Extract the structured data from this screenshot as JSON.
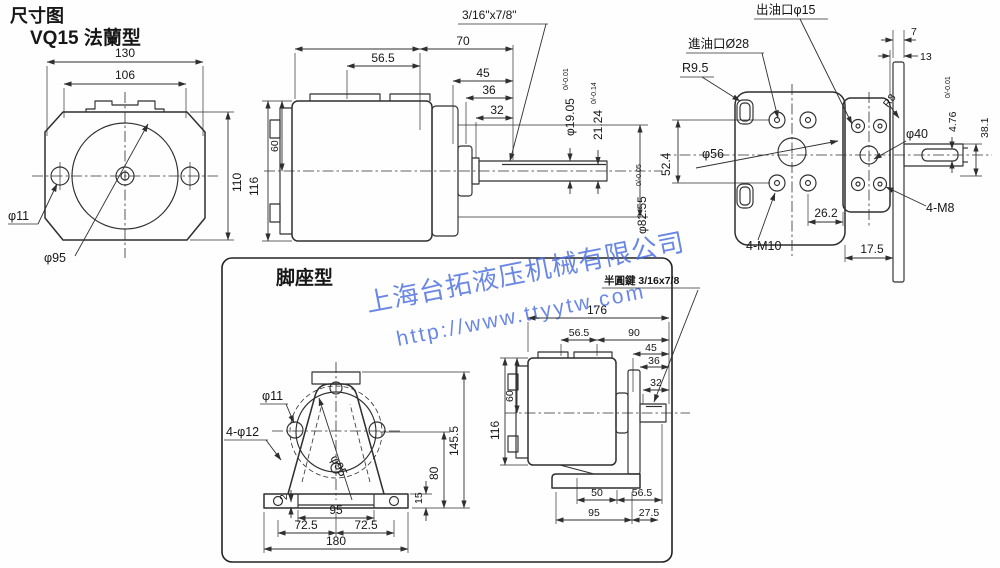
{
  "header": {
    "doc_title": "尺寸图",
    "model": "VQ15 法蘭型"
  },
  "watermark": {
    "company": "上海台拓液压机械有限公司",
    "url": "http://www.ttyytw.com",
    "color": "#4a6ee0"
  },
  "flange_front": {
    "outer_width": "130",
    "inner_width": "106",
    "height": "110",
    "bolt_hole": "φ11",
    "pilot": "φ95"
  },
  "side_view": {
    "key_spec": "3/16\"x7/8\"",
    "len_56_5": "56.5",
    "len_70": "70",
    "len_45": "45",
    "len_36": "36",
    "len_32": "32",
    "height_116": "116",
    "height_60": "60",
    "shaft_dia": "φ19.05",
    "shaft_dia_tol": "0/-0.01",
    "key_height": "21.24",
    "key_height_tol": "0/-0.14",
    "spigot_dia": "φ82.55",
    "spigot_dia_tol": "0/-0.05"
  },
  "rear_view": {
    "outlet_port": "出油口φ15",
    "inlet_port": "進油口Ø28",
    "corner_radius": "R9.5",
    "plate_thickness": "7",
    "plate_offset": "13",
    "plate_radius": "R8",
    "key_width": "4.76",
    "key_width_tol": "0/-0.01",
    "shaft_ext": "38.1",
    "bolt_span": "52.4",
    "pilot_dia": "φ56",
    "boss_dia": "φ40",
    "rear_bolts": "4-M10",
    "offset_26_2": "26.2",
    "offset_17_5": "17.5",
    "front_bolts": "4-M8"
  },
  "foot_section": {
    "title": "脚座型",
    "key_label": "半圓鍵 3/16x7/8"
  },
  "foot_front": {
    "bolt_hole": "φ11",
    "base_holes": "4-φ12",
    "height_145_5": "145.5",
    "center_height": "80",
    "base_thickness": "15",
    "lip": "2",
    "slot_width": "95",
    "half_left": "72.5",
    "half_right": "72.5",
    "base_width": "180",
    "pilot": "φ95"
  },
  "foot_side": {
    "total_length": "176",
    "len_56_5": "56.5",
    "len_90": "90",
    "len_45": "45",
    "len_36": "36",
    "len_32": "32",
    "height_116": "116",
    "height_60": "60",
    "foot_50": "50",
    "foot_56_5": "56.5",
    "foot_95": "95",
    "foot_27_5": "27.5"
  }
}
